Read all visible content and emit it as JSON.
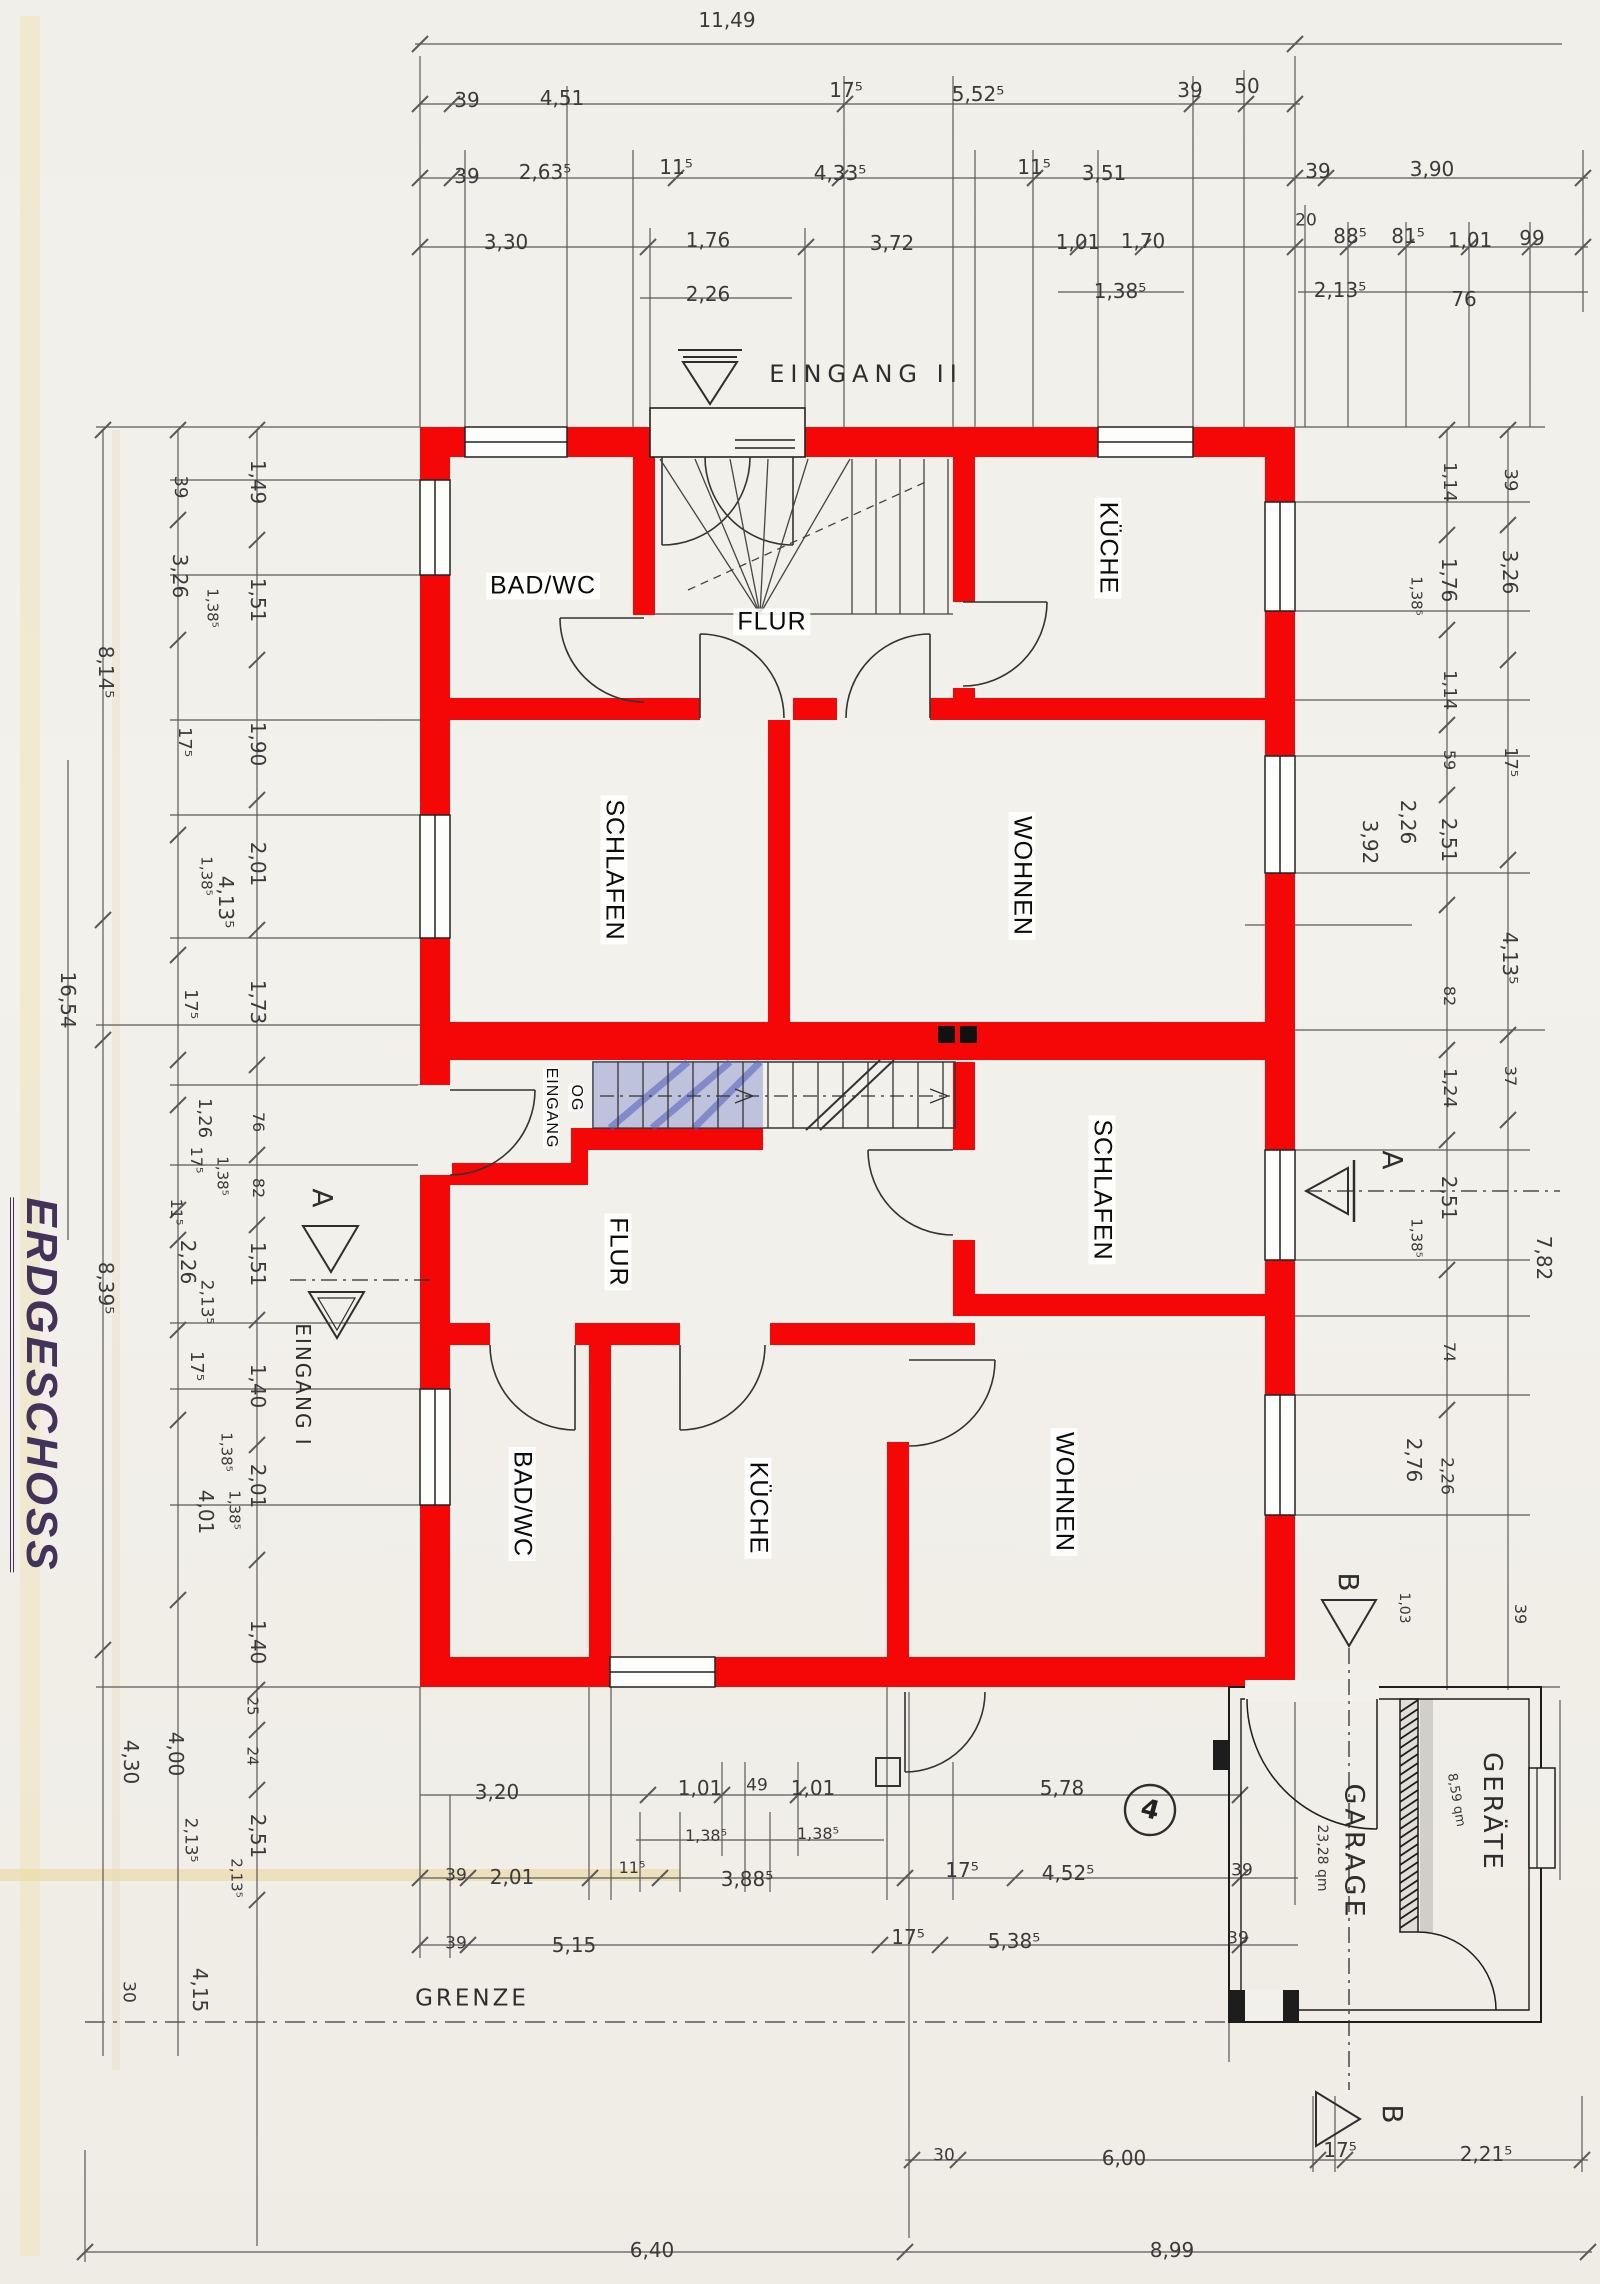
{
  "title": "ERDGESCHOSS",
  "colors": {
    "wall_red": "#f50708",
    "ink": "#2e2e2e",
    "dim_line": "#5a5a5a",
    "paper": "#f2f0ea",
    "stair_blue": "#6876c8",
    "table_edge": "#c8882f"
  },
  "labels": [
    {
      "t": "11,49",
      "x": 727,
      "y": 20
    },
    {
      "t": "39",
      "x": 467,
      "y": 100
    },
    {
      "t": "4,51",
      "x": 562,
      "y": 98
    },
    {
      "t": "17⁵",
      "x": 846,
      "y": 90
    },
    {
      "t": "5,52⁵",
      "x": 978,
      "y": 94
    },
    {
      "t": "39",
      "x": 1190,
      "y": 90
    },
    {
      "t": "50",
      "x": 1247,
      "y": 86
    },
    {
      "t": "39",
      "x": 467,
      "y": 176
    },
    {
      "t": "2,63⁵",
      "x": 545,
      "y": 172
    },
    {
      "t": "11⁵",
      "x": 676,
      "y": 167
    },
    {
      "t": "4,33⁵",
      "x": 840,
      "y": 173
    },
    {
      "t": "11⁵",
      "x": 1034,
      "y": 167
    },
    {
      "t": "3,51",
      "x": 1104,
      "y": 173
    },
    {
      "t": "39",
      "x": 1318,
      "y": 171
    },
    {
      "t": "3,90",
      "x": 1432,
      "y": 169
    },
    {
      "t": "3,30",
      "x": 506,
      "y": 242
    },
    {
      "t": "1,76",
      "x": 708,
      "y": 240
    },
    {
      "t": "3,72",
      "x": 892,
      "y": 243
    },
    {
      "t": "1,01",
      "x": 1078,
      "y": 242
    },
    {
      "t": "1,70",
      "x": 1143,
      "y": 241
    },
    {
      "t": "20",
      "x": 1306,
      "y": 221,
      "s": 17
    },
    {
      "t": "88⁵",
      "x": 1350,
      "y": 236
    },
    {
      "t": "81⁵",
      "x": 1408,
      "y": 236
    },
    {
      "t": "1,01",
      "x": 1470,
      "y": 240
    },
    {
      "t": "99",
      "x": 1532,
      "y": 238
    },
    {
      "t": "2,26",
      "x": 708,
      "y": 294
    },
    {
      "t": "1,38⁵",
      "x": 1120,
      "y": 291
    },
    {
      "t": "2,13⁵",
      "x": 1340,
      "y": 290
    },
    {
      "t": "76",
      "x": 1464,
      "y": 299
    },
    {
      "t": "EINGANG II",
      "x": 866,
      "y": 374,
      "s": 24,
      "ls": 6,
      "c": "marker"
    },
    {
      "t": "16,54",
      "x": 68,
      "y": 1000,
      "r": 90
    },
    {
      "t": "8,14⁵",
      "x": 106,
      "y": 672,
      "r": 90
    },
    {
      "t": "8,39⁵",
      "x": 106,
      "y": 1288,
      "r": 90
    },
    {
      "t": "4,30",
      "x": 131,
      "y": 1762,
      "r": 90
    },
    {
      "t": "30",
      "x": 128,
      "y": 1992,
      "r": 90,
      "s": 17
    },
    {
      "t": "39",
      "x": 180,
      "y": 487,
      "r": 90,
      "s": 18
    },
    {
      "t": "3,26",
      "x": 180,
      "y": 576,
      "r": 90
    },
    {
      "t": "1,38⁵",
      "x": 212,
      "y": 608,
      "r": 90,
      "s": 15
    },
    {
      "t": "17⁵",
      "x": 184,
      "y": 742,
      "r": 90,
      "s": 18
    },
    {
      "t": "1,38⁵",
      "x": 206,
      "y": 876,
      "r": 90,
      "s": 15
    },
    {
      "t": "4,13⁵",
      "x": 226,
      "y": 902,
      "r": 90
    },
    {
      "t": "17⁵",
      "x": 190,
      "y": 1004,
      "r": 90,
      "s": 18
    },
    {
      "t": "1,26",
      "x": 204,
      "y": 1118,
      "r": 90,
      "s": 18
    },
    {
      "t": "17⁵",
      "x": 196,
      "y": 1160,
      "r": 90,
      "s": 16
    },
    {
      "t": "1,38⁵",
      "x": 222,
      "y": 1176,
      "r": 90,
      "s": 15
    },
    {
      "t": "11⁵",
      "x": 176,
      "y": 1212,
      "r": 90,
      "s": 16
    },
    {
      "t": "2,26",
      "x": 188,
      "y": 1262,
      "r": 90
    },
    {
      "t": "2,13⁵",
      "x": 206,
      "y": 1302,
      "r": 90,
      "s": 17
    },
    {
      "t": "17⁵",
      "x": 196,
      "y": 1366,
      "r": 90,
      "s": 18
    },
    {
      "t": "1,38⁵",
      "x": 226,
      "y": 1452,
      "r": 90,
      "s": 15
    },
    {
      "t": "4,01",
      "x": 206,
      "y": 1512,
      "r": 90
    },
    {
      "t": "4,00",
      "x": 176,
      "y": 1754,
      "r": 90
    },
    {
      "t": "2,13⁵",
      "x": 190,
      "y": 1840,
      "r": 90,
      "s": 17
    },
    {
      "t": "4,15",
      "x": 200,
      "y": 1990,
      "r": 90
    },
    {
      "t": "1,49",
      "x": 258,
      "y": 482,
      "r": 90
    },
    {
      "t": "1,51",
      "x": 258,
      "y": 600,
      "r": 90
    },
    {
      "t": "1,90",
      "x": 258,
      "y": 744,
      "r": 90
    },
    {
      "t": "2,01",
      "x": 258,
      "y": 864,
      "r": 90
    },
    {
      "t": "1,73",
      "x": 258,
      "y": 1002,
      "r": 90
    },
    {
      "t": "76",
      "x": 258,
      "y": 1122,
      "r": 90,
      "s": 16
    },
    {
      "t": "82",
      "x": 258,
      "y": 1188,
      "r": 90,
      "s": 16
    },
    {
      "t": "1,51",
      "x": 258,
      "y": 1264,
      "r": 90
    },
    {
      "t": "1,40",
      "x": 258,
      "y": 1386,
      "r": 90
    },
    {
      "t": "2,01",
      "x": 258,
      "y": 1486,
      "r": 90
    },
    {
      "t": "1,38⁵",
      "x": 234,
      "y": 1510,
      "r": 90,
      "s": 15
    },
    {
      "t": "1,40",
      "x": 258,
      "y": 1642,
      "r": 90
    },
    {
      "t": "25",
      "x": 252,
      "y": 1706,
      "r": 90,
      "s": 15
    },
    {
      "t": "24",
      "x": 252,
      "y": 1756,
      "r": 90,
      "s": 15
    },
    {
      "t": "2,51",
      "x": 258,
      "y": 1836,
      "r": 90
    },
    {
      "t": "2,13⁵",
      "x": 236,
      "y": 1878,
      "r": 90,
      "s": 15
    },
    {
      "t": "1,14",
      "x": 1449,
      "y": 482,
      "r": 90,
      "s": 18
    },
    {
      "t": "1,76",
      "x": 1449,
      "y": 580,
      "r": 90
    },
    {
      "t": "1,38⁵",
      "x": 1416,
      "y": 596,
      "r": 90,
      "s": 15
    },
    {
      "t": "1,14",
      "x": 1449,
      "y": 690,
      "r": 90,
      "s": 18
    },
    {
      "t": "59",
      "x": 1449,
      "y": 760,
      "r": 90,
      "s": 16
    },
    {
      "t": "2,51",
      "x": 1449,
      "y": 840,
      "r": 90
    },
    {
      "t": "82",
      "x": 1449,
      "y": 996,
      "r": 90,
      "s": 16
    },
    {
      "t": "1,24",
      "x": 1449,
      "y": 1088,
      "r": 90,
      "s": 18
    },
    {
      "t": "2,51",
      "x": 1449,
      "y": 1198,
      "r": 90
    },
    {
      "t": "1,38⁵",
      "x": 1416,
      "y": 1238,
      "r": 90,
      "s": 15
    },
    {
      "t": "74",
      "x": 1449,
      "y": 1352,
      "r": 90,
      "s": 16
    },
    {
      "t": "2,76",
      "x": 1414,
      "y": 1460,
      "r": 90
    },
    {
      "t": "2,26",
      "x": 1446,
      "y": 1476,
      "r": 90,
      "s": 17
    },
    {
      "t": "1,03",
      "x": 1404,
      "y": 1608,
      "r": 90,
      "s": 14
    },
    {
      "t": "39",
      "x": 1520,
      "y": 1614,
      "r": 90,
      "s": 16
    },
    {
      "t": "39",
      "x": 1510,
      "y": 480,
      "r": 90,
      "s": 18
    },
    {
      "t": "3,26",
      "x": 1510,
      "y": 572,
      "r": 90
    },
    {
      "t": "17⁵",
      "x": 1510,
      "y": 762,
      "r": 90,
      "s": 18
    },
    {
      "t": "4,13⁵",
      "x": 1510,
      "y": 958,
      "r": 90
    },
    {
      "t": "37",
      "x": 1510,
      "y": 1076,
      "r": 90,
      "s": 16
    },
    {
      "t": "7,82",
      "x": 1544,
      "y": 1258,
      "r": 90
    },
    {
      "t": "2,26",
      "x": 1408,
      "y": 822,
      "r": 90
    },
    {
      "t": "3,92",
      "x": 1370,
      "y": 842,
      "r": 90
    },
    {
      "t": "BAD/WC",
      "x": 543,
      "y": 586,
      "c": "room",
      "s": 25
    },
    {
      "t": "FLUR",
      "x": 772,
      "y": 622,
      "c": "room",
      "s": 25
    },
    {
      "t": "KÜCHE",
      "x": 1108,
      "y": 548,
      "r": 90,
      "c": "room",
      "s": 25
    },
    {
      "t": "SCHLAFEN",
      "x": 614,
      "y": 870,
      "r": 90,
      "c": "room",
      "s": 25
    },
    {
      "t": "WOHNEN",
      "x": 1022,
      "y": 876,
      "r": 90,
      "c": "room",
      "s": 25
    },
    {
      "t": "EINGANG",
      "x": 551,
      "y": 1108,
      "r": 90,
      "s": 16,
      "c": "room-s"
    },
    {
      "t": "OG",
      "x": 576,
      "y": 1098,
      "r": 90,
      "s": 16,
      "c": "room-s"
    },
    {
      "t": "FLUR",
      "x": 618,
      "y": 1252,
      "r": 90,
      "c": "room",
      "s": 25
    },
    {
      "t": "SCHLAFEN",
      "x": 1102,
      "y": 1190,
      "r": 90,
      "c": "room",
      "s": 25
    },
    {
      "t": "BAD/WC",
      "x": 522,
      "y": 1504,
      "r": 90,
      "c": "room",
      "s": 25
    },
    {
      "t": "KÜCHE",
      "x": 758,
      "y": 1508,
      "r": 90,
      "c": "room",
      "s": 25
    },
    {
      "t": "WOHNEN",
      "x": 1064,
      "y": 1492,
      "r": 90,
      "c": "room",
      "s": 25
    },
    {
      "t": "A",
      "x": 322,
      "y": 1198,
      "r": 90,
      "s": 28,
      "c": "marker"
    },
    {
      "t": "EINGANG I",
      "x": 303,
      "y": 1385,
      "r": 90,
      "s": 20,
      "ls": 2,
      "c": "marker"
    },
    {
      "t": "A",
      "x": 1392,
      "y": 1160,
      "r": 90,
      "s": 28,
      "c": "marker"
    },
    {
      "t": "B",
      "x": 1348,
      "y": 1582,
      "r": 90,
      "s": 28,
      "c": "marker"
    },
    {
      "t": "B",
      "x": 1392,
      "y": 2114,
      "r": 90,
      "s": 28,
      "c": "marker"
    },
    {
      "t": "3,20",
      "x": 497,
      "y": 1792
    },
    {
      "t": "1,01",
      "x": 700,
      "y": 1788
    },
    {
      "t": "49",
      "x": 757,
      "y": 1786,
      "s": 17
    },
    {
      "t": "1,01",
      "x": 813,
      "y": 1788
    },
    {
      "t": "5,78",
      "x": 1062,
      "y": 1788
    },
    {
      "t": "1,38⁵",
      "x": 706,
      "y": 1836,
      "s": 16
    },
    {
      "t": "1,38⁵",
      "x": 818,
      "y": 1834,
      "s": 16
    },
    {
      "t": "39",
      "x": 456,
      "y": 1876,
      "s": 17
    },
    {
      "t": "2,01",
      "x": 512,
      "y": 1877
    },
    {
      "t": "11⁵",
      "x": 632,
      "y": 1868,
      "s": 16
    },
    {
      "t": "3,88⁵",
      "x": 747,
      "y": 1879
    },
    {
      "t": "17⁵",
      "x": 962,
      "y": 1870
    },
    {
      "t": "4,52⁵",
      "x": 1068,
      "y": 1873
    },
    {
      "t": "39",
      "x": 1242,
      "y": 1871,
      "s": 17
    },
    {
      "t": "39",
      "x": 456,
      "y": 1944,
      "s": 17
    },
    {
      "t": "5,15",
      "x": 574,
      "y": 1945
    },
    {
      "t": "17⁵",
      "x": 908,
      "y": 1937
    },
    {
      "t": "5,38⁵",
      "x": 1014,
      "y": 1941
    },
    {
      "t": "39",
      "x": 1238,
      "y": 1939,
      "s": 17
    },
    {
      "t": "GRENZE",
      "x": 472,
      "y": 1999,
      "s": 23,
      "ls": 3,
      "c": "marker"
    },
    {
      "t": "30",
      "x": 944,
      "y": 2156,
      "s": 17
    },
    {
      "t": "6,00",
      "x": 1124,
      "y": 2158
    },
    {
      "t": "17⁵",
      "x": 1340,
      "y": 2150
    },
    {
      "t": "2,21⁵",
      "x": 1486,
      "y": 2154
    },
    {
      "t": "6,40",
      "x": 652,
      "y": 2250
    },
    {
      "t": "8,99",
      "x": 1172,
      "y": 2250
    },
    {
      "t": "GARAGE",
      "x": 1354,
      "y": 1852,
      "r": 90,
      "s": 27,
      "ls": 4,
      "c": "marker"
    },
    {
      "t": "23,28 qm",
      "x": 1322,
      "y": 1858,
      "r": 90,
      "s": 14
    },
    {
      "t": "GERÄTE",
      "x": 1492,
      "y": 1812,
      "r": 90,
      "s": 26,
      "ls": 3,
      "c": "marker"
    },
    {
      "t": "8,59 qm",
      "x": 1456,
      "y": 1800,
      "r": 80,
      "s": 13
    },
    {
      "t": "4",
      "x": 1150,
      "y": 1810,
      "s": 26,
      "r": 15,
      "c": "hand"
    }
  ]
}
